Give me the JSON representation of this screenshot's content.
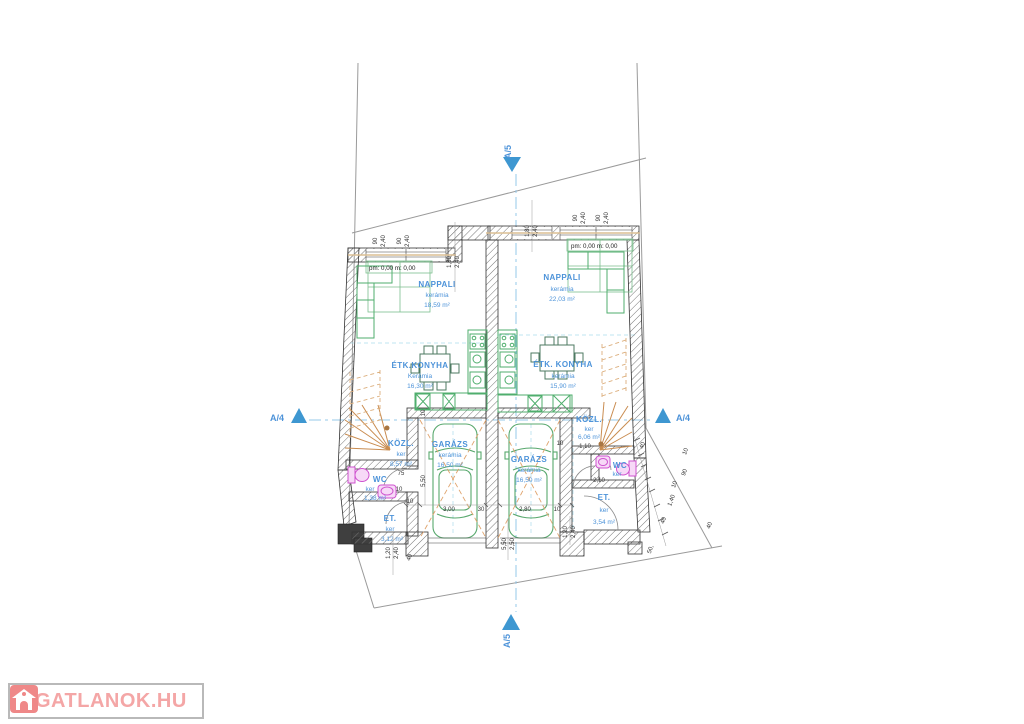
{
  "logo": {
    "brand": "INGATLANOK.HU"
  },
  "markers": {
    "a4": "A/4",
    "a5": "A/5"
  },
  "levels": {
    "left": "pm: 0,00 m: 0,00",
    "right": "pm: 0,00 m: 0,00"
  },
  "rooms": {
    "l_nappali": {
      "name": "NAPPALI",
      "finish": "kerámia",
      "area": "18,59 m²"
    },
    "l_konyha": {
      "name": "ÉTK.KONYHA",
      "finish": "Kerámia",
      "area": "16,30 m²"
    },
    "l_kozl": {
      "name": "KÖZL.",
      "finish": "ker",
      "area": "8,57 m²"
    },
    "l_wc": {
      "name": "WC",
      "finish": "ker",
      "area": "1,38 m²"
    },
    "l_garazs": {
      "name": "GARÁZS",
      "finish": "kerámia",
      "area": "16,50 m²"
    },
    "l_et": {
      "name": "ET.",
      "finish": "ker",
      "area": "3,12 m²"
    },
    "r_nappali": {
      "name": "NAPPALI",
      "finish": "kerámia",
      "area": "22,03 m²"
    },
    "r_konyha": {
      "name": "ÉTK. KONYHA",
      "finish": "kerámia",
      "area": "15,90 m²"
    },
    "r_kozl": {
      "name": "KÖZL.",
      "finish": "ker",
      "area": "6,06 m²"
    },
    "r_wc": {
      "name": "WC",
      "finish": "ker"
    },
    "r_garazs": {
      "name": "GARÁZS",
      "finish": "kerámia",
      "area": "16,50 m²"
    },
    "r_et": {
      "name": "ET.",
      "finish": "ker",
      "area": "3,54 m²"
    }
  },
  "dims": {
    "d90": "90",
    "d240": "2,40",
    "d180": "1,80",
    "d550": "5,50",
    "d250": "2,50",
    "d300": "3,00",
    "d280": "2,80",
    "d30": "30",
    "d10": "10",
    "d75": "75",
    "d110": "1,10",
    "d120": "1,20",
    "d140": "1,40",
    "d40": "40",
    "d210": "2,10",
    "d50": "50,"
  },
  "colors": {
    "label_blue": "#4d93d9",
    "furniture_green": "#4fae6d",
    "stairs_orange": "#cf8d4e",
    "fixture_magenta": "#cf52cf",
    "section_blue": "#3e97d1",
    "logo_pink": "#f4a6a6"
  }
}
